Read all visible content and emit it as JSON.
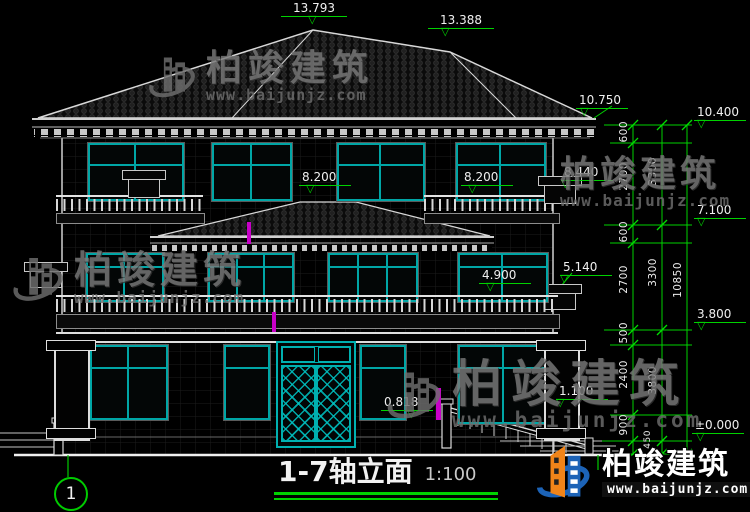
{
  "title": {
    "name": "1-7轴立面",
    "scale": "1:100"
  },
  "axis": {
    "label": "1"
  },
  "elevations": {
    "apex_main": "13.793",
    "apex_secondary": "13.388",
    "eave_upper": "10.750",
    "eave": "10.400",
    "rail3_left": "8.200",
    "rail3_right": "8.200",
    "cap3": "8.440",
    "level3": "7.100",
    "cap2": "5.140",
    "rail2": "4.900",
    "level2": "3.800",
    "porch_cap": "1.100",
    "porch": "0.818",
    "ground": "±0.000"
  },
  "dims": {
    "inner": [
      "600",
      "2700",
      "600",
      "2700",
      "500",
      "2400",
      "900",
      "450"
    ],
    "middle": [
      "3300",
      "3300",
      "3800"
    ],
    "overall": "10850"
  },
  "watermark": {
    "brand": "柏竣建筑",
    "url": "www.baijunjz.com"
  },
  "colors": {
    "teal": "#00a6a6",
    "dim_green": "#00d200",
    "magenta": "#c800c8",
    "brand_blue": "#1c63b7",
    "brand_orange": "#f08419",
    "line_white": "#e0e0e0"
  }
}
